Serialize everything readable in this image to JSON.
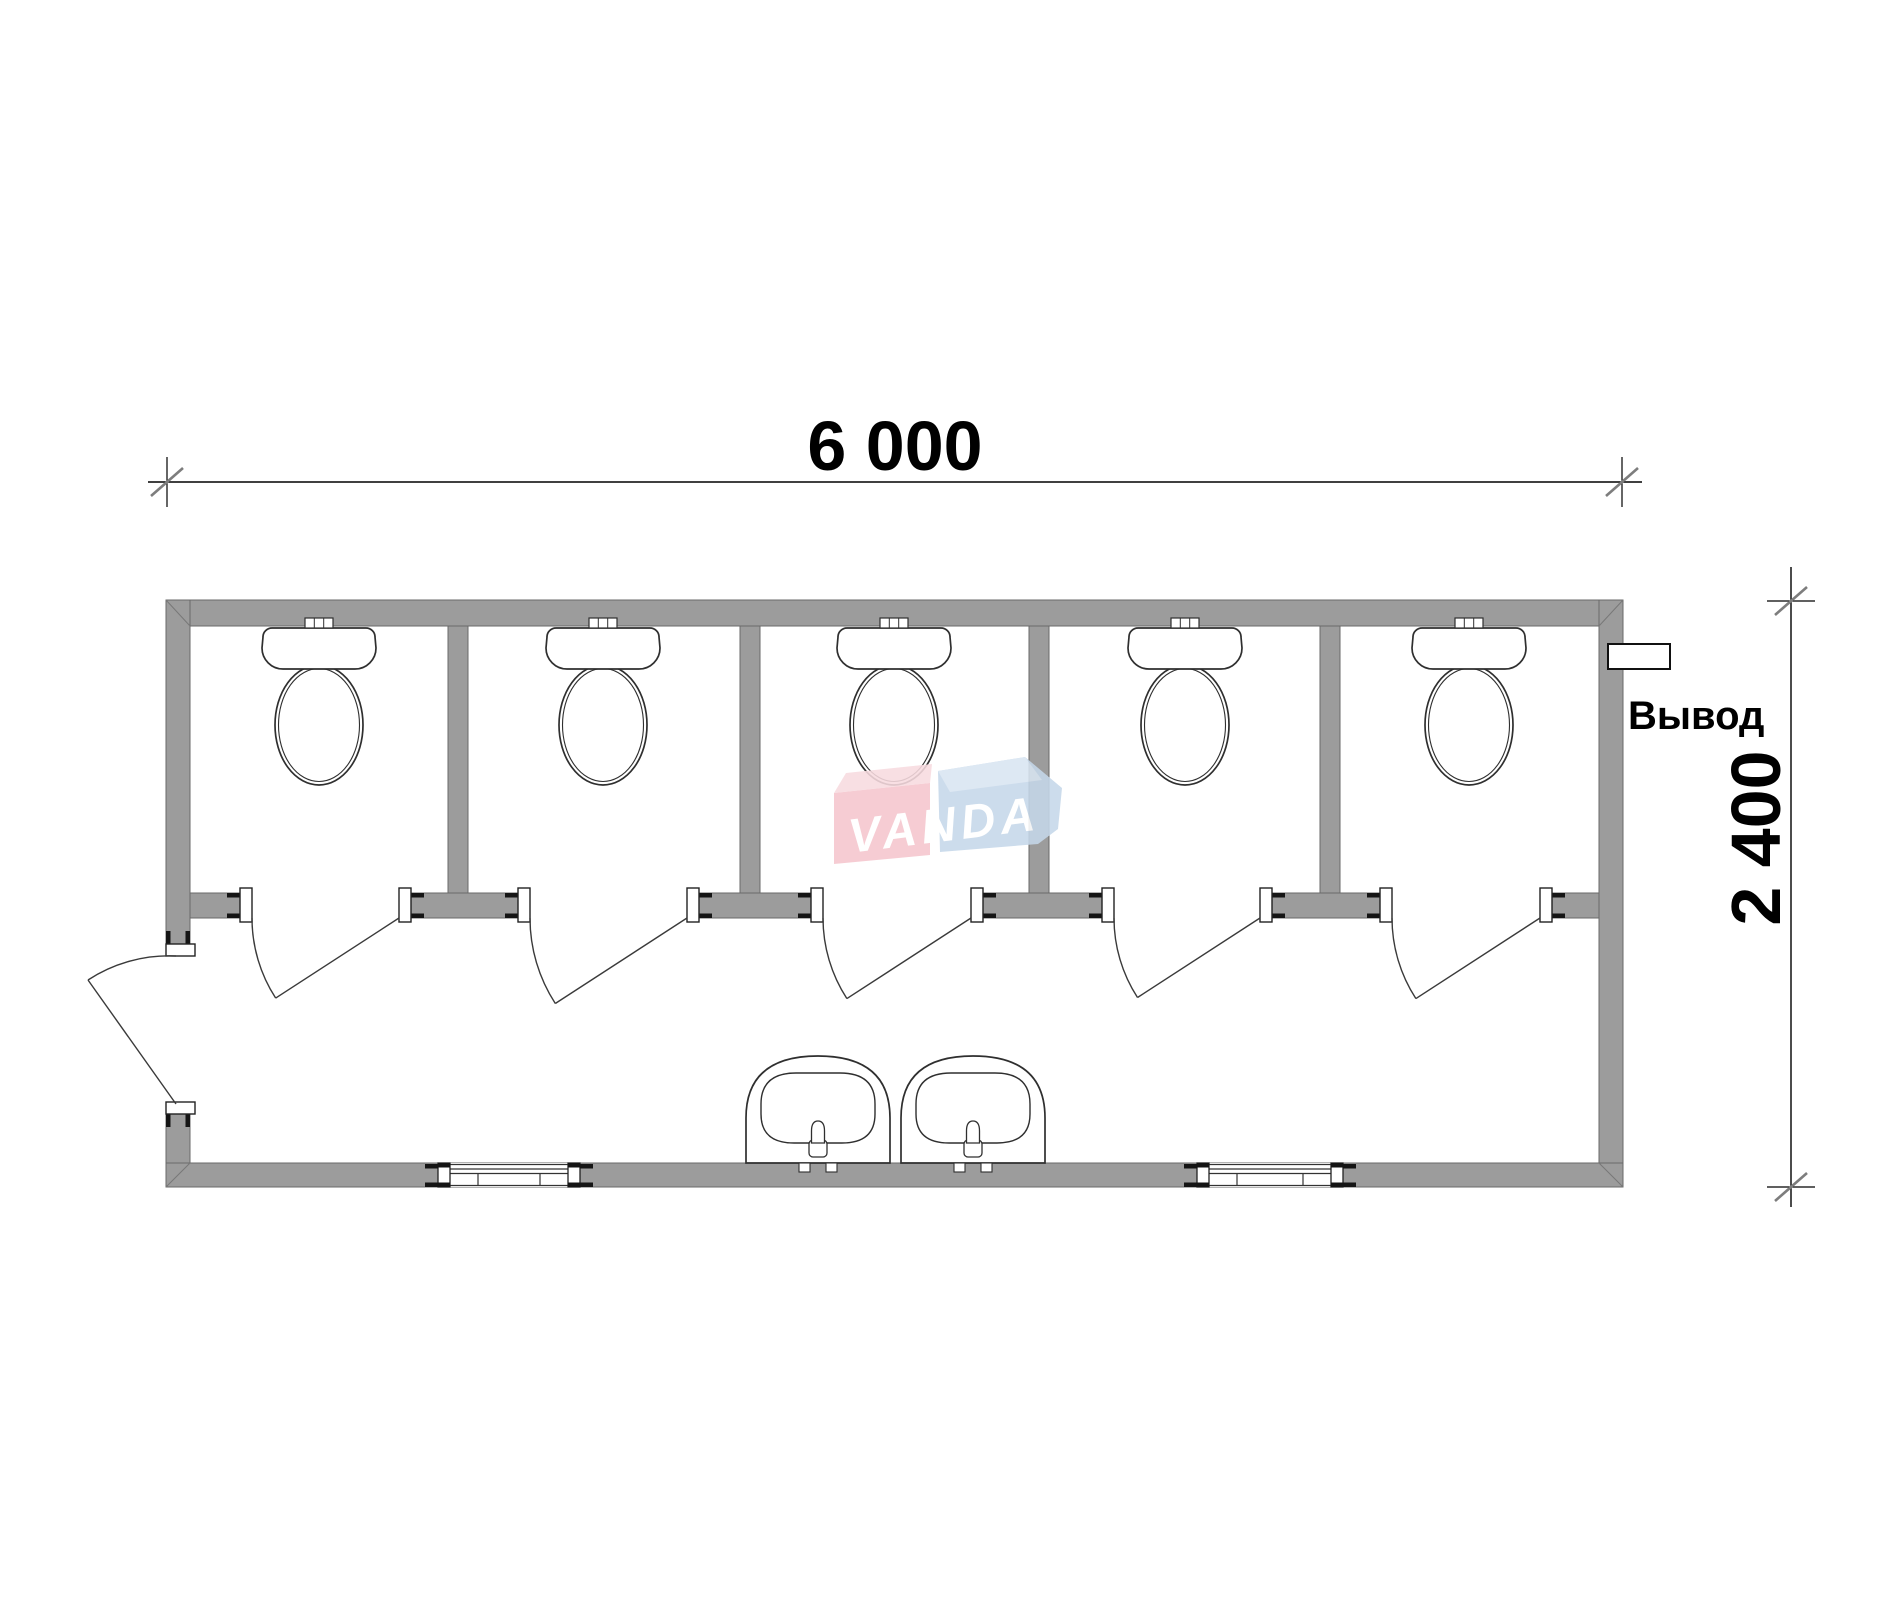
{
  "drawing": {
    "title": "sanitary-cabin-floor-plan",
    "width_dimension": "6 000",
    "height_dimension": "2 400",
    "outlet_label": "Вывод",
    "watermark_text": "VANDA",
    "toilet_count": 5,
    "stall_count": 5,
    "sink_count": 2,
    "window_count": 2,
    "stall_door_count": 5,
    "entry_door_count": 1
  },
  "colors": {
    "background": "#ffffff",
    "wall_fill": "#9c9c9c",
    "wall_edge": "#6a6a6a",
    "cap_black": "#151515",
    "fixture_line": "#2f2f2f",
    "door_line": "#3a3a3a",
    "dim_line": "#000000",
    "tick_slash": "#7d7d7d",
    "miter_line": "#787878",
    "text": "#000000",
    "watermark_pink": "#f5c6cd",
    "watermark_pink_light": "#f8dbe0",
    "watermark_blue": "#c6d8ea",
    "watermark_blue_light": "#d9e5f2",
    "watermark_text_color": "#ffffff"
  }
}
